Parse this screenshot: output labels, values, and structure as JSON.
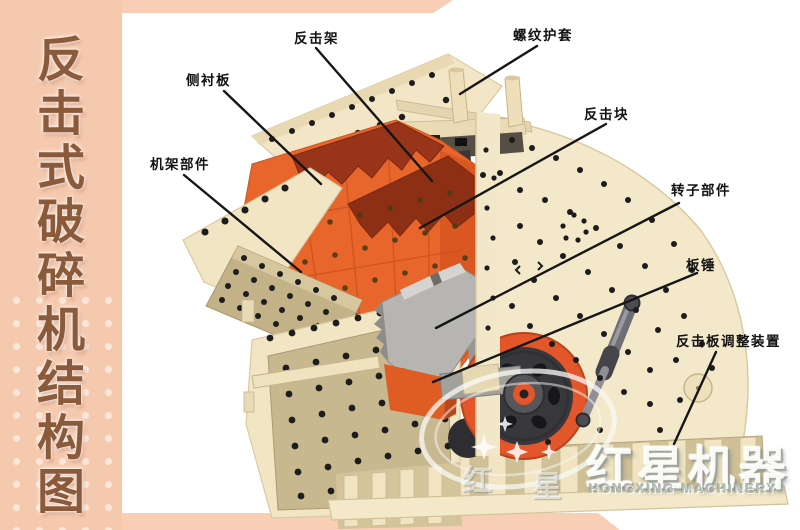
{
  "sidebar": {
    "bg_color": "#f5c9ae",
    "text_color": "#8b5a3b",
    "title": "反击式破碎机结构图",
    "title_chars": [
      "反",
      "击",
      "式",
      "破",
      "碎",
      "机",
      "结",
      "构",
      "图"
    ]
  },
  "diagram": {
    "labels": [
      {
        "id": "impact-frame",
        "text": "反击架"
      },
      {
        "id": "thread-sleeve",
        "text": "螺纹护套"
      },
      {
        "id": "side-liner",
        "text": "侧衬板"
      },
      {
        "id": "impact-block",
        "text": "反击块"
      },
      {
        "id": "frame-parts",
        "text": "机架部件"
      },
      {
        "id": "rotor-parts",
        "text": "转子部件"
      },
      {
        "id": "blow-bar",
        "text": "板锤"
      },
      {
        "id": "impact-plate-adjuster",
        "text": "反击板调整装置"
      }
    ],
    "colors": {
      "machine_body_cream": "#f2e6c6",
      "chamber_orange": "#e8662c",
      "impact_rack_maroon": "#97341a",
      "rotor_gray": "#b7b5b1",
      "flywheel_orange": "#e2562a",
      "bolt_panel_tan": "#c3b288",
      "accent_pink": "#f5c9ae",
      "label_line_black": "#161616"
    }
  },
  "watermark": {
    "cn": "红星机器",
    "en": "HONGXING MACHINERY",
    "faint_chars": [
      "红",
      "星"
    ]
  }
}
